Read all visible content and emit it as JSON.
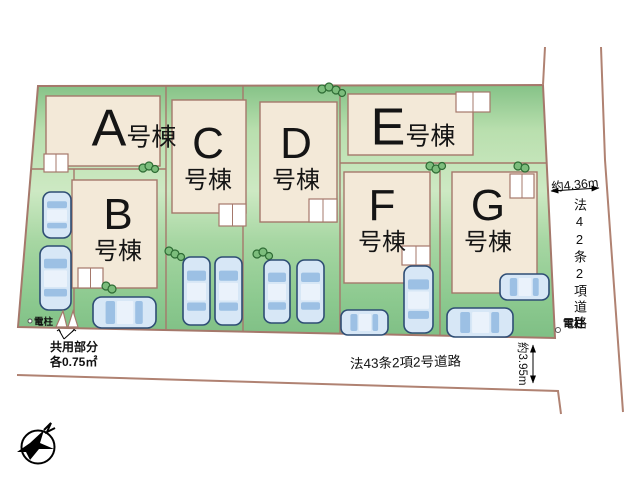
{
  "site_plan": {
    "buildings": [
      {
        "id": "a",
        "letter": "A",
        "suffix": "号棟",
        "layout": "inline",
        "rect": [
          46,
          96,
          114,
          70
        ],
        "porch": [
          44,
          154,
          24,
          18
        ],
        "label": [
          134,
          129
        ]
      },
      {
        "id": "b",
        "letter": "B",
        "suffix": "号棟",
        "layout": "stacked",
        "rect": [
          72,
          180,
          85,
          108
        ],
        "porch": [
          78,
          268,
          25,
          20
        ],
        "label": [
          118,
          229
        ]
      },
      {
        "id": "c",
        "letter": "C",
        "suffix": "号棟",
        "layout": "stacked",
        "rect": [
          172,
          100,
          74,
          113
        ],
        "porch": [
          219,
          204,
          27,
          22
        ],
        "label": [
          208,
          158
        ]
      },
      {
        "id": "d",
        "letter": "D",
        "suffix": "号棟",
        "layout": "stacked",
        "rect": [
          260,
          102,
          77,
          120
        ],
        "porch": [
          309,
          199,
          28,
          23
        ],
        "label": [
          296,
          158
        ]
      },
      {
        "id": "e",
        "letter": "E",
        "suffix": "号棟",
        "layout": "inline",
        "rect": [
          348,
          94,
          125,
          61
        ],
        "porch": [
          456,
          92,
          34,
          20
        ],
        "label": [
          413,
          128
        ]
      },
      {
        "id": "f",
        "letter": "F",
        "suffix": "号棟",
        "layout": "stacked",
        "rect": [
          344,
          172,
          86,
          111
        ],
        "porch": [
          402,
          246,
          28,
          19
        ],
        "label": [
          382,
          220
        ]
      },
      {
        "id": "g",
        "letter": "G",
        "suffix": "号棟",
        "layout": "stacked",
        "rect": [
          452,
          172,
          85,
          121
        ],
        "porch": [
          510,
          174,
          24,
          24
        ],
        "label": [
          488,
          220
        ]
      }
    ],
    "annotations": {
      "common_area_line1": "共用部分",
      "common_area_line2": "各0.75㎡",
      "pole_left": "電柱",
      "pole_right": "電柱",
      "road_right_width": "約4.36m",
      "road_right_name": "法42条2項道路",
      "road_bottom_name": "法43条2項2号道路",
      "road_bottom_width": "約3.95m"
    },
    "cars": [
      {
        "x": 43,
        "y": 192,
        "w": 28,
        "h": 46,
        "o": "v"
      },
      {
        "x": 40,
        "y": 246,
        "w": 31,
        "h": 64,
        "o": "v"
      },
      {
        "x": 93,
        "y": 297,
        "w": 63,
        "h": 31,
        "o": "h"
      },
      {
        "x": 183,
        "y": 257,
        "w": 27,
        "h": 68,
        "o": "v"
      },
      {
        "x": 215,
        "y": 257,
        "w": 27,
        "h": 68,
        "o": "v"
      },
      {
        "x": 264,
        "y": 260,
        "w": 26,
        "h": 63,
        "o": "v"
      },
      {
        "x": 297,
        "y": 260,
        "w": 27,
        "h": 63,
        "o": "v"
      },
      {
        "x": 341,
        "y": 310,
        "w": 47,
        "h": 25,
        "o": "h"
      },
      {
        "x": 404,
        "y": 266,
        "w": 29,
        "h": 67,
        "o": "v"
      },
      {
        "x": 447,
        "y": 308,
        "w": 66,
        "h": 29,
        "o": "h"
      },
      {
        "x": 500,
        "y": 274,
        "w": 49,
        "h": 26,
        "o": "h"
      }
    ],
    "trees": [
      [
        143,
        168,
        4
      ],
      [
        149,
        166,
        4
      ],
      [
        155,
        169,
        3.5
      ],
      [
        322,
        89,
        4
      ],
      [
        329,
        87,
        4
      ],
      [
        336,
        90,
        4
      ],
      [
        342,
        93,
        3.5
      ],
      [
        169,
        251,
        4
      ],
      [
        175,
        254,
        4
      ],
      [
        181,
        257,
        3.5
      ],
      [
        257,
        254,
        4
      ],
      [
        263,
        252,
        4
      ],
      [
        269,
        256,
        3.5
      ],
      [
        430,
        166,
        4
      ],
      [
        436,
        169,
        4
      ],
      [
        442,
        166,
        3.5
      ],
      [
        518,
        166,
        4
      ],
      [
        525,
        168,
        4
      ],
      [
        106,
        286,
        4
      ],
      [
        112,
        289,
        4
      ]
    ],
    "colors": {
      "site_green_light": "#cde9c3",
      "site_green_dark": "#85c287",
      "outline_brown": "#a5786b",
      "road_line": "#b08272",
      "building_fill": "#f3e9d8",
      "porch_fill": "#ffffff",
      "car_body": "#d7e7f6",
      "car_outline": "#2e4d74",
      "car_glass": "#9cc0e4",
      "tree_fill": "#7cbd7c",
      "tree_outline": "#2e6b34"
    }
  }
}
